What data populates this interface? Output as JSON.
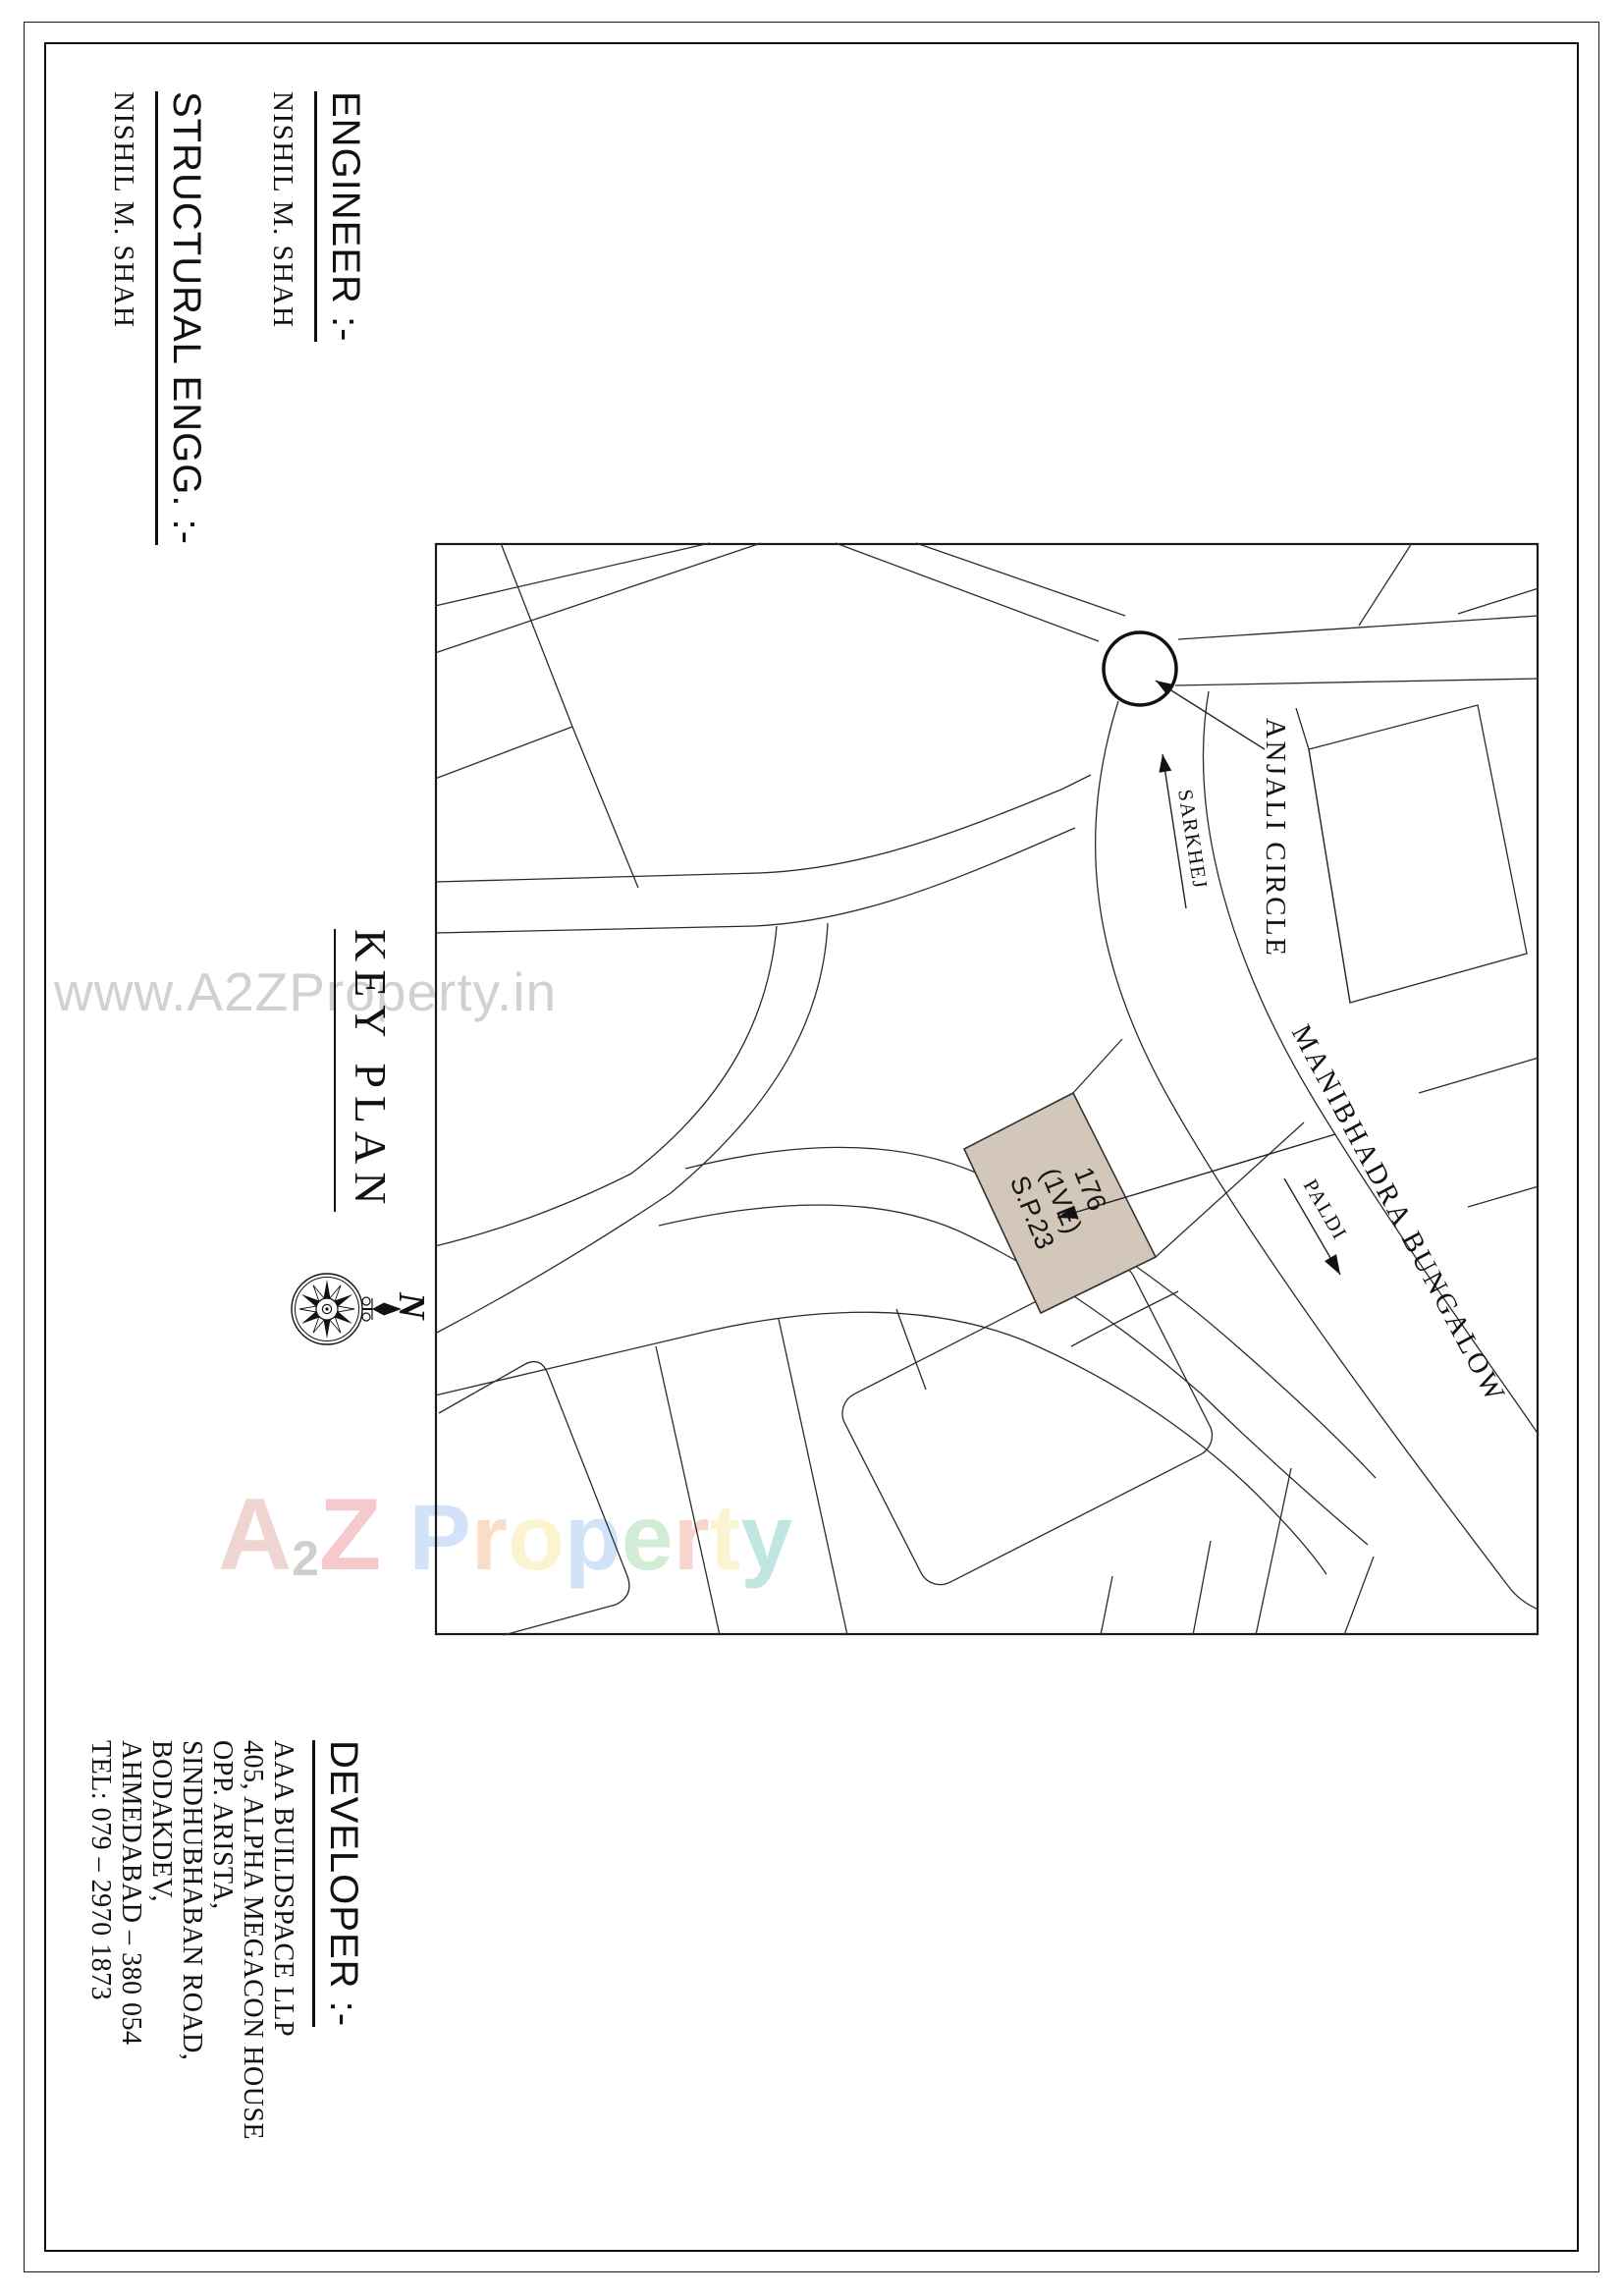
{
  "engineer": {
    "heading": "ENGINEER :-",
    "name": "NISHIL M. SHAH"
  },
  "structural": {
    "heading": "STRUCTURAL ENGG. :-",
    "name": "NISHIL M. SHAH"
  },
  "key_plan": {
    "title": "KEY PLAN",
    "compass_north": "N"
  },
  "map": {
    "labels": {
      "circle": "ANJALI CIRCLE",
      "road_to": "SARKHEJ",
      "road_from": "PALDI",
      "road_main": "MANIBHADRA BUNGALOW"
    },
    "plot": {
      "line1": "176",
      "line2": "(1VE)",
      "line3": "S.P.23"
    },
    "plot_color": "#d2c7b8",
    "line_color": "#2b2b2b"
  },
  "developer": {
    "heading": "DEVELOPER :-",
    "lines": [
      "AAA BUILDSPACE LLP",
      "405, ALPHA MEGACON HOUSE",
      "OPP. ARISTA,",
      "SINDHUBHABAN ROAD,",
      "BODAKDEV,",
      "AHMEDABAD – 380 054",
      "TEL: 079 – 2970 1873"
    ]
  },
  "watermarks": {
    "url": "www.A2ZProperty.in",
    "url_color": "#c9c9c9",
    "brand_letters": [
      {
        "ch": "A",
        "color": "#e2b3ae"
      },
      {
        "ch": "2",
        "color": "#a3ada3"
      },
      {
        "ch": "Z",
        "color": "#ef9fa4"
      },
      {
        "ch": "P",
        "color": "#aecbf5"
      },
      {
        "ch": "r",
        "color": "#f6c39b"
      },
      {
        "ch": "o",
        "color": "#f8ecaa"
      },
      {
        "ch": "p",
        "color": "#aecbf5"
      },
      {
        "ch": "e",
        "color": "#aeddb6"
      },
      {
        "ch": "r",
        "color": "#f4b4a4"
      },
      {
        "ch": "t",
        "color": "#f8ecaa"
      },
      {
        "ch": "y",
        "color": "#8fd2c9"
      }
    ]
  }
}
